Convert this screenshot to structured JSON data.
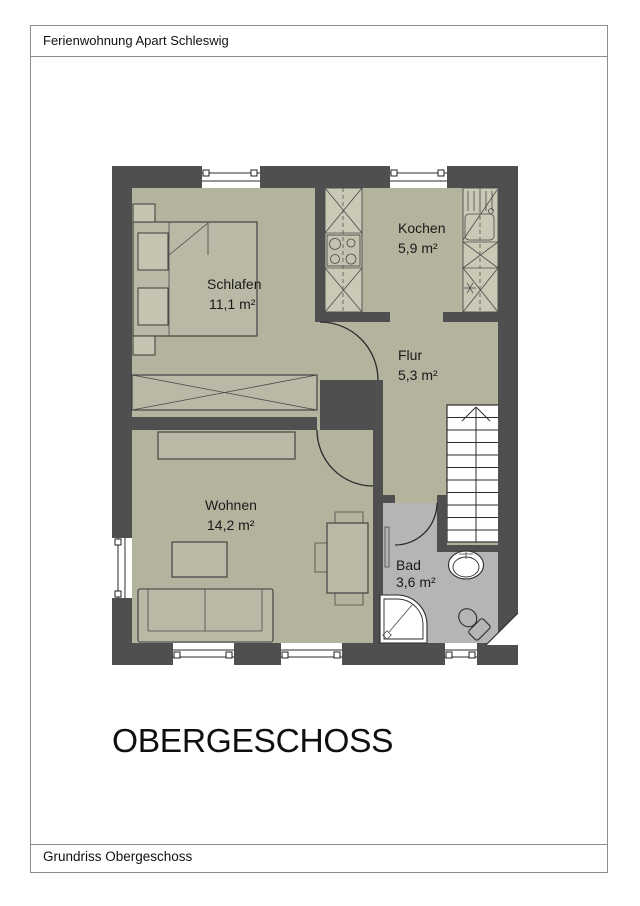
{
  "page": {
    "header_title": "Ferienwohnung Apart Schleswig",
    "floor_title": "OBERGESCHOSS",
    "footer_caption": "Grundriss Obergeschoss"
  },
  "rooms": {
    "schlafen": {
      "name": "Schlafen",
      "area": "11,1 m²"
    },
    "kochen": {
      "name": "Kochen",
      "area": "5,9 m²"
    },
    "flur": {
      "name": "Flur",
      "area": "5,3 m²"
    },
    "wohnen": {
      "name": "Wohnen",
      "area": "14,2 m²"
    },
    "bad": {
      "name": "Bad",
      "area": "3,6 m²"
    }
  },
  "colors": {
    "wall": "#4f4f4f",
    "floor": "#b3b39e",
    "bad_floor": "#b5b5b5",
    "counter": "#c9c9b6",
    "furniture": "#b9b9a6",
    "frame_line": "#8d8d8d"
  }
}
